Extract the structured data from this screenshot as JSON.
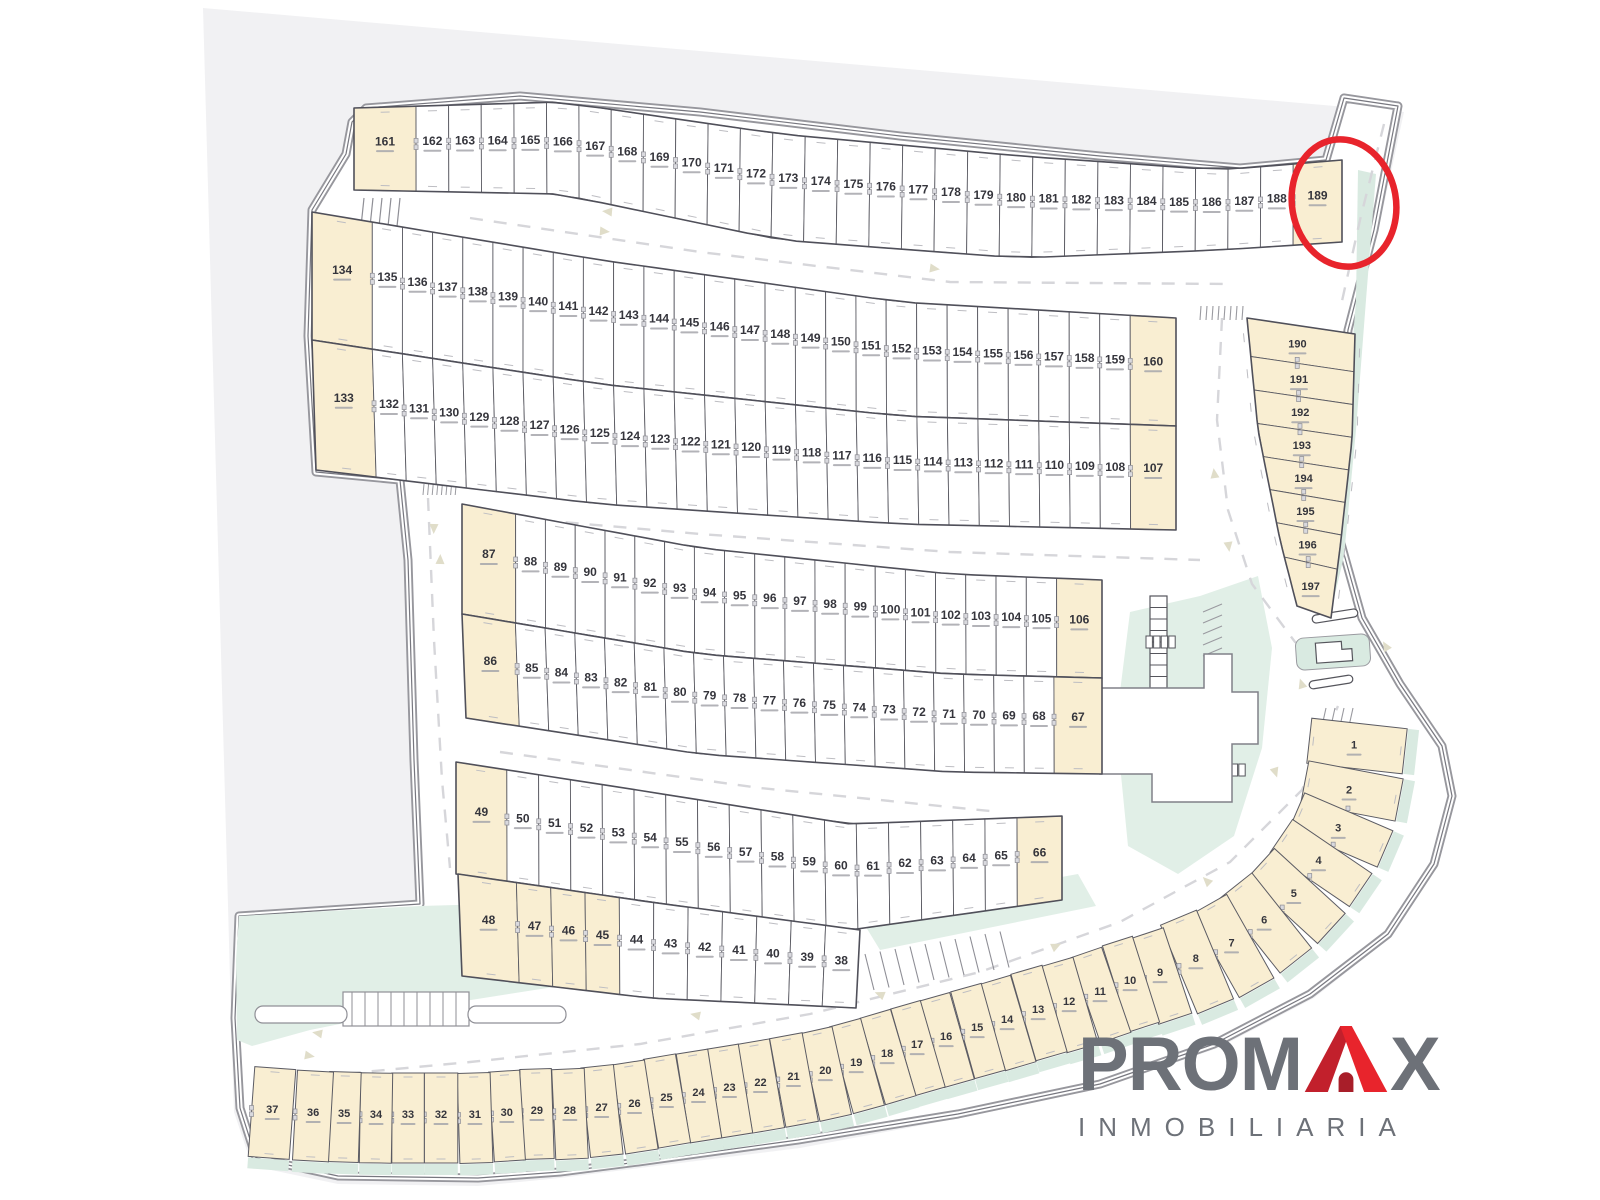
{
  "map": {
    "highlighted_lot": 189,
    "blocks": [
      {
        "id": "top-row",
        "lots": [
          161,
          162,
          163,
          164,
          165,
          166,
          167,
          168,
          169,
          170,
          171,
          172,
          173,
          174,
          175,
          176,
          177,
          178,
          179,
          180,
          181,
          182,
          183,
          184,
          185,
          186,
          187,
          188,
          189
        ],
        "cream": [
          161,
          189
        ]
      },
      {
        "id": "row2-upper",
        "lots": [
          134,
          135,
          136,
          137,
          138,
          139,
          140,
          141,
          142,
          143,
          144,
          145,
          146,
          147,
          148,
          149,
          150,
          151,
          152,
          153,
          154,
          155,
          156,
          157,
          158,
          159,
          160
        ],
        "cream": [
          134,
          160
        ]
      },
      {
        "id": "row2-lower",
        "lots": [
          133,
          132,
          131,
          130,
          129,
          128,
          127,
          126,
          125,
          124,
          123,
          122,
          121,
          120,
          119,
          118,
          117,
          116,
          115,
          114,
          113,
          112,
          111,
          110,
          109,
          108,
          107
        ],
        "cream": [
          133,
          107
        ]
      },
      {
        "id": "row3-upper",
        "lots": [
          87,
          88,
          89,
          90,
          91,
          92,
          93,
          94,
          95,
          96,
          97,
          98,
          99,
          100,
          101,
          102,
          103,
          104,
          105,
          106
        ],
        "cream": [
          87,
          106
        ]
      },
      {
        "id": "row3-lower",
        "lots": [
          86,
          85,
          84,
          83,
          82,
          81,
          80,
          79,
          78,
          77,
          76,
          75,
          74,
          73,
          72,
          71,
          70,
          69,
          68,
          67
        ],
        "cream": [
          86,
          67
        ]
      },
      {
        "id": "row4-upper",
        "lots": [
          49,
          50,
          51,
          52,
          53,
          54,
          55,
          56,
          57,
          58,
          59,
          60,
          61,
          62,
          63,
          64,
          65,
          66
        ],
        "cream": [
          49,
          66
        ]
      },
      {
        "id": "row4-lower",
        "lots": [
          48,
          47,
          46,
          45,
          44,
          43,
          42,
          41,
          40,
          39,
          38
        ],
        "cream": [
          48,
          47,
          46,
          45
        ]
      },
      {
        "id": "east-column",
        "lots": [
          190,
          191,
          192,
          193,
          194,
          195,
          196,
          197
        ],
        "cream": "all"
      },
      {
        "id": "south-arc",
        "lots": [
          1,
          2,
          3,
          4,
          5,
          6,
          7,
          8,
          9,
          10,
          11,
          12,
          13,
          14,
          15,
          16,
          17,
          18,
          19,
          20,
          21,
          22,
          23,
          24,
          25,
          26,
          27,
          28,
          29,
          30,
          31,
          32,
          33,
          34,
          35,
          36,
          37
        ],
        "cream": "all"
      }
    ],
    "annotation": {
      "type": "circle",
      "lot": 189
    }
  },
  "logo": {
    "brand": "PROMAX",
    "brand_prefix": "PROM",
    "brand_suffix": "X",
    "subtitle": "INMOBILIARIA"
  },
  "colors": {
    "page_bg": "#ffffff",
    "site_gray": "#f1f1f3",
    "road_white": "#ffffff",
    "curb_gray": "#97979d",
    "curb_dark": "#77777f",
    "lot_outline": "#5b5b63",
    "lot_cream": "#f9eed2",
    "lot_white": "#ffffff",
    "green": "#e1efe7",
    "green_strip": "#d9eae1",
    "dash_gray": "#d6d6da",
    "arrow_beige": "#e0ddc9",
    "number_dark": "#35353c",
    "sub_gray": "#a6a6ac",
    "highlight_red": "#e8242c",
    "logo_gray": "#6d7178",
    "logo_red": "#e8242c",
    "logo_red_dark": "#c2202c",
    "logo_door": "#a81e29"
  }
}
